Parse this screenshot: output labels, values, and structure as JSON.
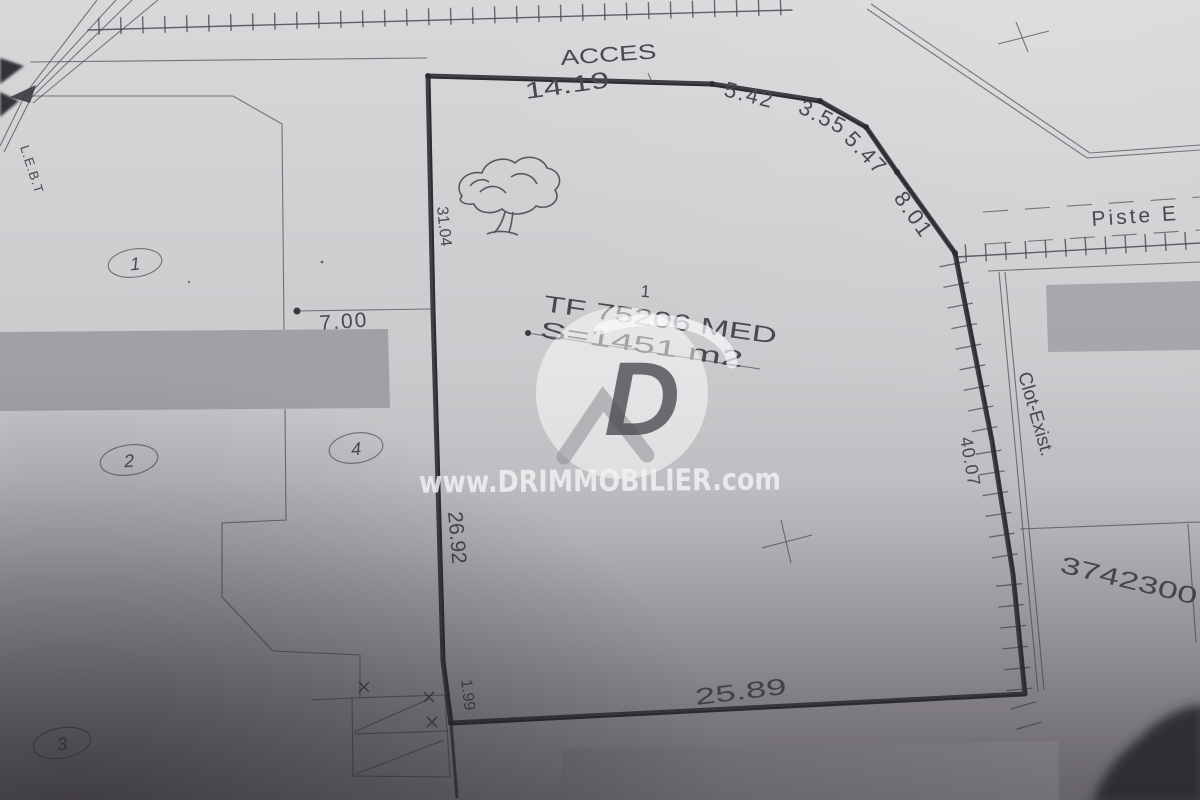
{
  "labels": {
    "acces": "ACCES",
    "piste": "Piste E",
    "clot_exist": "Clot-Exist.",
    "lebt": "L.E.B.T",
    "coordinate": "3742300"
  },
  "parcel": {
    "plot_number": "1",
    "title_deed": "TF 75206 MED",
    "area": "S=1451 m2"
  },
  "measurements": {
    "north": "14.19",
    "ne_1": "5.42",
    "ne_2": "3.55",
    "ne_3": "5.47",
    "ne_4": "8.01",
    "east": "40.07",
    "south": "25.89",
    "sw_corner": "1.99",
    "west_lower": "26.92",
    "west_upper": "31.04",
    "interior_west": "7.00"
  },
  "neighbor_plots": {
    "p1": "1",
    "p2": "2",
    "p3": "3",
    "p4": "4"
  },
  "watermark": {
    "site": "www.DRIMMOBILIER.com",
    "logo_letter": "D"
  },
  "colors": {
    "paper_light": "#d7d6d8",
    "paper_mid": "#c7c5c9",
    "paper_dark": "#8a878c",
    "ink": "#4b4850",
    "boundary_ink": "#34323a",
    "redaction_gray": "#a3a1a5",
    "watermark_white": "#f2f1f4"
  }
}
